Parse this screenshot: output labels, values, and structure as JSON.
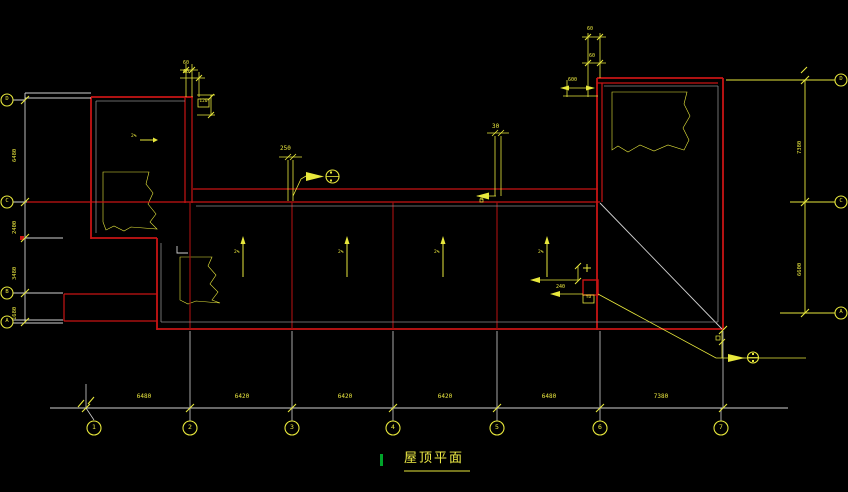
{
  "title": {
    "text": "屋顶平面"
  },
  "colors": {
    "background": "#000000",
    "roof_outline_red": "#c81414",
    "axis_line_red": "#9b0f0f",
    "annotation_yellow": "#e8e83c",
    "line_white": "#d0d0d0",
    "marker_green": "#00a32a"
  },
  "axis_grid": {
    "bottom_dimensions": [
      "6480",
      "6420",
      "6420",
      "6420",
      "6480",
      "7380"
    ],
    "left_dimensions": [
      "6480",
      "2400",
      "3480",
      "1680"
    ],
    "right_dimensions": [
      "7380",
      "6600"
    ],
    "bottom_bubble_labels": [
      "1",
      "2",
      "3",
      "4",
      "5",
      "6",
      "7"
    ],
    "left_bubble_labels": [
      "D",
      "C",
      "B",
      "A"
    ],
    "right_bubble_labels": [
      "D",
      "C",
      "A"
    ]
  },
  "annotations": {
    "parapet_dim": "250",
    "gutter_dim": "30",
    "topleft_dim_a": "60",
    "topleft_dim_b": "60",
    "topleft_flag": "120",
    "topright_dim_a": "60",
    "topright_dim_b": "60",
    "topright_dim_c": "600",
    "drain_dim": "240",
    "drain_flag": "YD",
    "leader_mark": "4",
    "slope_label": "2%"
  }
}
